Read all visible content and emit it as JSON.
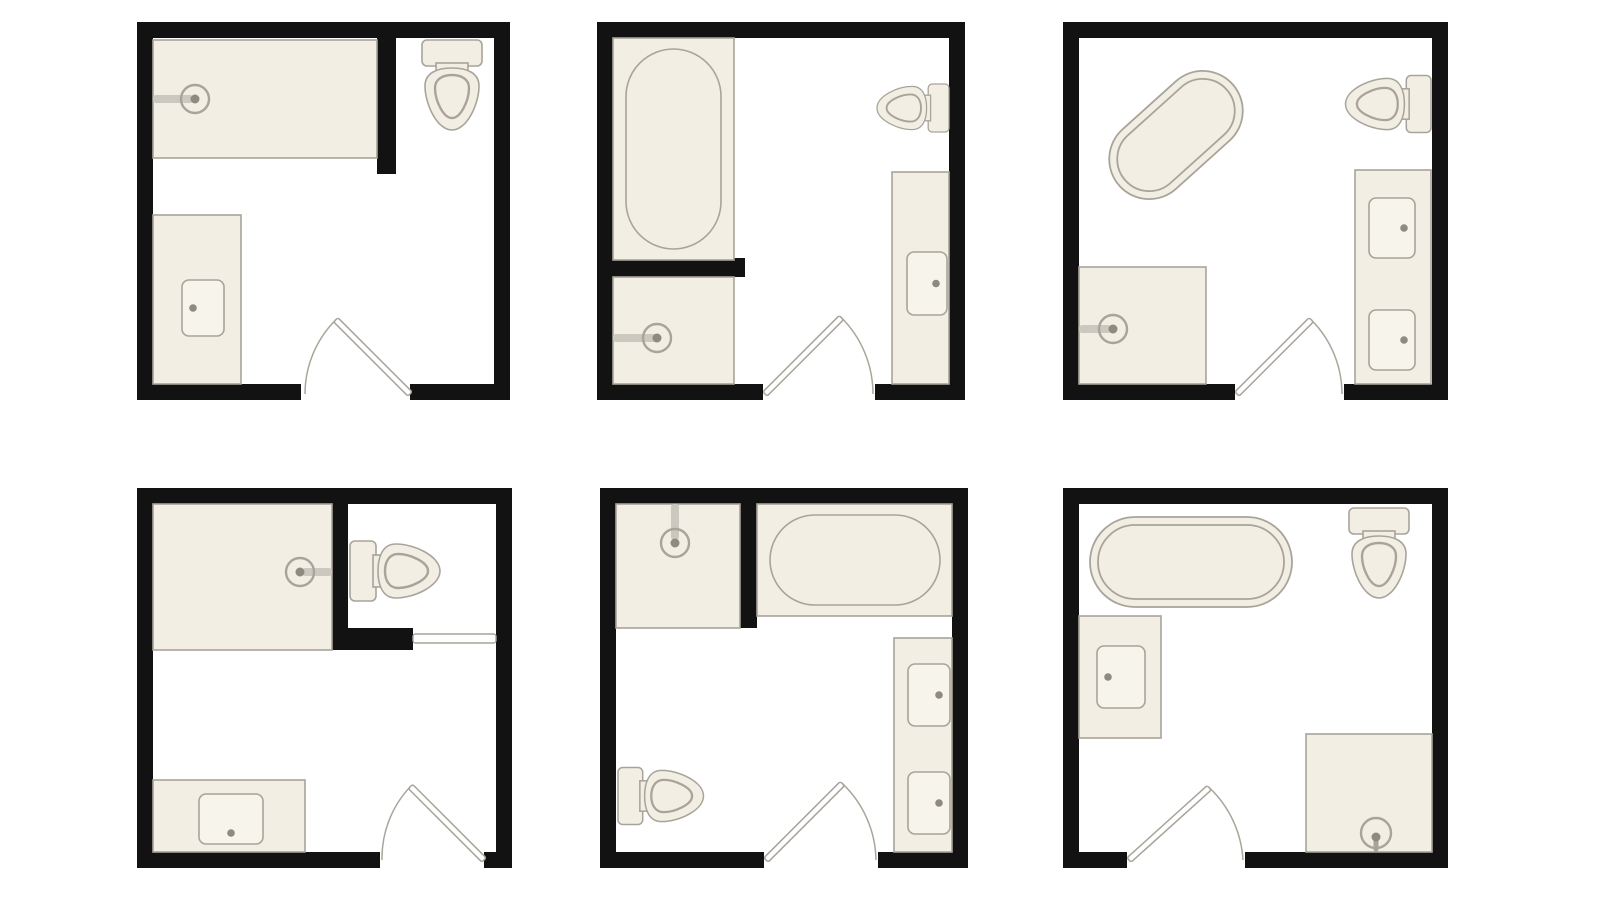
{
  "figure": {
    "kind": "bathroom-floor-plan-grid",
    "rows": 2,
    "cols": 3,
    "background": "#ffffff"
  },
  "style": {
    "wall": "#121212",
    "room_fill": "#ffffff",
    "fixture_fill": "#f2eee3",
    "fixture_stroke": "#a8a49a",
    "sink_fill": "#f7f4ec",
    "dot": "#8e8a80",
    "arm_light": "#cbc8bf",
    "arm_dark": "#a8a49a",
    "door_fill": "#ffffff",
    "line": "#aaa69c"
  },
  "plans": [
    {
      "name": "bathroom-plan-1",
      "x": 137,
      "y": 22,
      "w": 373,
      "h": 378,
      "wall": 16,
      "partitions": [
        {
          "x": 240,
          "y": 0,
          "w": 19,
          "h": 152
        }
      ],
      "gaps": [
        {
          "side": "bottom",
          "from": 164,
          "to": 273
        }
      ],
      "fixtures": [
        {
          "type": "area",
          "name": "shower-area",
          "x": 16,
          "y": 18,
          "w": 224,
          "h": 118
        },
        {
          "type": "shower_head",
          "name": "shower-head",
          "cx": 58,
          "cy": 77,
          "r": 14,
          "dot_r": 4.5,
          "arm": {
            "x": 16,
            "y": 73,
            "w": 40,
            "h": 8,
            "tone": "light"
          }
        },
        {
          "type": "toilet",
          "name": "toilet",
          "facing": "down",
          "ax": 315,
          "ay": 18,
          "scale": 1
        },
        {
          "type": "area",
          "name": "vanity",
          "x": 16,
          "y": 193,
          "w": 88,
          "h": 169
        },
        {
          "type": "sink",
          "name": "sink",
          "x": 45,
          "y": 258,
          "w": 42,
          "h": 56,
          "dot": "left"
        }
      ],
      "door": {
        "name": "door-swing",
        "hinge": [
          273,
          372
        ],
        "angle": 225,
        "len": 105,
        "arc_end": [
          168,
          372
        ],
        "sweep": 0
      }
    },
    {
      "name": "bathroom-plan-2",
      "x": 597,
      "y": 22,
      "w": 368,
      "h": 378,
      "wall": 16,
      "partitions": [
        {
          "x": 0,
          "y": 236,
          "w": 148,
          "h": 19
        }
      ],
      "gaps": [
        {
          "side": "bottom",
          "from": 166,
          "to": 278
        }
      ],
      "fixtures": [
        {
          "type": "tub_alcove",
          "name": "bathtub-alcove",
          "x": 16,
          "y": 16,
          "w": 121,
          "h": 222,
          "capsule": {
            "x": 29,
            "y": 27,
            "w": 95,
            "h": 200
          }
        },
        {
          "type": "area",
          "name": "shower-area",
          "x": 16,
          "y": 255,
          "w": 121,
          "h": 107
        },
        {
          "type": "shower_head",
          "name": "shower-head",
          "cx": 60,
          "cy": 316,
          "r": 14,
          "dot_r": 4.5,
          "arm": {
            "x": 16,
            "y": 312,
            "w": 44,
            "h": 8,
            "tone": "light"
          }
        },
        {
          "type": "toilet",
          "name": "toilet",
          "facing": "left",
          "ax": 352,
          "ay": 86,
          "scale": 0.8
        },
        {
          "type": "area",
          "name": "vanity",
          "x": 295,
          "y": 150,
          "w": 57,
          "h": 212
        },
        {
          "type": "sink",
          "name": "sink",
          "x": 310,
          "y": 230,
          "w": 40,
          "h": 63,
          "dot": "right"
        }
      ],
      "door": {
        "name": "door-swing",
        "hinge": [
          168,
          372
        ],
        "angle": 315,
        "len": 108,
        "arc_end": [
          276,
          372
        ],
        "sweep": 1
      }
    },
    {
      "name": "bathroom-plan-3",
      "x": 1063,
      "y": 22,
      "w": 385,
      "h": 378,
      "wall": 16,
      "partitions": [],
      "gaps": [
        {
          "side": "bottom",
          "from": 172,
          "to": 281
        }
      ],
      "fixtures": [
        {
          "type": "tub_freestanding",
          "name": "bathtub-freestanding",
          "cx": 113,
          "cy": 113,
          "w": 152,
          "h": 80,
          "rot": -42
        },
        {
          "type": "toilet",
          "name": "toilet",
          "facing": "left",
          "ax": 368,
          "ay": 82,
          "scale": 0.95
        },
        {
          "type": "area",
          "name": "vanity",
          "x": 292,
          "y": 148,
          "w": 76,
          "h": 214
        },
        {
          "type": "sink",
          "name": "sink",
          "x": 306,
          "y": 176,
          "w": 46,
          "h": 60,
          "dot": "right"
        },
        {
          "type": "sink",
          "name": "sink",
          "x": 306,
          "y": 288,
          "w": 46,
          "h": 60,
          "dot": "right"
        },
        {
          "type": "area",
          "name": "shower-area",
          "x": 16,
          "y": 245,
          "w": 127,
          "h": 117
        },
        {
          "type": "shower_head",
          "name": "shower-head",
          "cx": 50,
          "cy": 307,
          "r": 14,
          "dot_r": 4.5,
          "arm": {
            "x": 16,
            "y": 303,
            "w": 32,
            "h": 8,
            "tone": "light"
          }
        }
      ],
      "door": {
        "name": "door-swing",
        "hinge": [
          174,
          372
        ],
        "angle": 315,
        "len": 105,
        "arc_end": [
          279,
          372
        ],
        "sweep": 1
      }
    },
    {
      "name": "bathroom-plan-4",
      "x": 137,
      "y": 488,
      "w": 375,
      "h": 380,
      "wall": 16,
      "partitions": [
        {
          "x": 195,
          "y": 0,
          "w": 16,
          "h": 162
        },
        {
          "x": 195,
          "y": 140,
          "w": 81,
          "h": 22
        }
      ],
      "gaps": [
        {
          "side": "bottom",
          "from": 243,
          "to": 347
        }
      ],
      "fixtures": [
        {
          "type": "area",
          "name": "shower-area",
          "x": 16,
          "y": 16,
          "w": 179,
          "h": 146
        },
        {
          "type": "shower_head",
          "name": "shower-head",
          "cx": 163,
          "cy": 84,
          "r": 14,
          "dot_r": 4.5,
          "arm": {
            "x": 165,
            "y": 80,
            "w": 30,
            "h": 8,
            "tone": "light"
          }
        },
        {
          "type": "toilet",
          "name": "toilet",
          "facing": "right",
          "ax": 213,
          "ay": 83,
          "scale": 1
        },
        {
          "type": "panel",
          "name": "sliding-door",
          "x": 276,
          "y": 146,
          "w": 83,
          "h": 9
        },
        {
          "type": "area",
          "name": "vanity",
          "x": 16,
          "y": 292,
          "w": 152,
          "h": 72
        },
        {
          "type": "sink",
          "name": "sink",
          "x": 62,
          "y": 306,
          "w": 64,
          "h": 50,
          "dot": "bottom"
        }
      ],
      "door": {
        "name": "door-swing",
        "hinge": [
          347,
          372
        ],
        "angle": 225,
        "len": 104,
        "arc_end": [
          245,
          372
        ],
        "sweep": 0
      }
    },
    {
      "name": "bathroom-plan-5",
      "x": 600,
      "y": 488,
      "w": 368,
      "h": 380,
      "wall": 16,
      "partitions": [
        {
          "x": 140,
          "y": 0,
          "w": 17,
          "h": 140
        }
      ],
      "gaps": [
        {
          "side": "bottom",
          "from": 164,
          "to": 278
        }
      ],
      "fixtures": [
        {
          "type": "area",
          "name": "shower-area",
          "x": 16,
          "y": 16,
          "w": 124,
          "h": 124
        },
        {
          "type": "shower_head",
          "name": "shower-head",
          "cx": 75,
          "cy": 55,
          "r": 14,
          "dot_r": 4.5,
          "arm": {
            "x": 71,
            "y": 16,
            "w": 8,
            "h": 36,
            "tone": "light"
          }
        },
        {
          "type": "tub_alcove",
          "name": "bathtub-alcove",
          "x": 157,
          "y": 16,
          "w": 195,
          "h": 112,
          "capsule": {
            "x": 170,
            "y": 27,
            "w": 170,
            "h": 90
          }
        },
        {
          "type": "area",
          "name": "vanity",
          "x": 294,
          "y": 150,
          "w": 58,
          "h": 214
        },
        {
          "type": "sink",
          "name": "sink",
          "x": 308,
          "y": 176,
          "w": 42,
          "h": 62,
          "dot": "right"
        },
        {
          "type": "sink",
          "name": "sink",
          "x": 308,
          "y": 284,
          "w": 42,
          "h": 62,
          "dot": "right"
        },
        {
          "type": "toilet",
          "name": "toilet",
          "facing": "right",
          "ax": 18,
          "ay": 308,
          "scale": 0.95
        }
      ],
      "door": {
        "name": "door-swing",
        "hinge": [
          166,
          372
        ],
        "angle": 315,
        "len": 108,
        "arc_end": [
          276,
          372
        ],
        "sweep": 1
      }
    },
    {
      "name": "bathroom-plan-6",
      "x": 1063,
      "y": 488,
      "w": 385,
      "h": 380,
      "wall": 16,
      "partitions": [],
      "gaps": [
        {
          "side": "bottom",
          "from": 64,
          "to": 182
        }
      ],
      "fixtures": [
        {
          "type": "tub_freestanding",
          "name": "bathtub-freestanding",
          "cx": 128,
          "cy": 74,
          "w": 202,
          "h": 90,
          "rot": 0
        },
        {
          "type": "toilet",
          "name": "toilet",
          "facing": "down",
          "ax": 316,
          "ay": 20,
          "scale": 1
        },
        {
          "type": "area",
          "name": "vanity",
          "x": 16,
          "y": 128,
          "w": 82,
          "h": 122
        },
        {
          "type": "sink",
          "name": "sink",
          "x": 34,
          "y": 158,
          "w": 48,
          "h": 62,
          "dot": "left"
        },
        {
          "type": "area",
          "name": "shower-area",
          "x": 243,
          "y": 246,
          "w": 126,
          "h": 118
        },
        {
          "type": "shower_head",
          "name": "shower-head",
          "cx": 313,
          "cy": 345,
          "r": 15,
          "dot_r": 4.5,
          "dot_dy": 4,
          "arm": {
            "x": 310.5,
            "y": 349,
            "w": 5,
            "h": 15,
            "tone": "dark"
          }
        }
      ],
      "door": {
        "name": "door-swing",
        "hinge": [
          66,
          372
        ],
        "angle": 318,
        "len": 108,
        "arc_end": [
          180,
          372
        ],
        "sweep": 1
      }
    }
  ]
}
